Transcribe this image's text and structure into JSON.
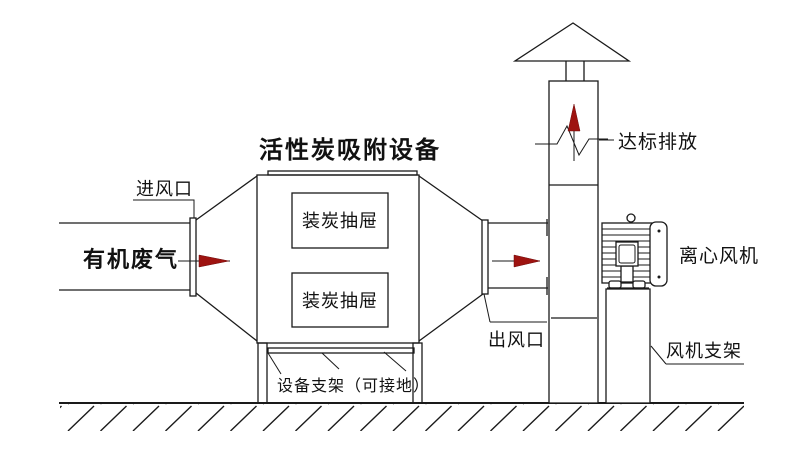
{
  "diagram": {
    "title": "活性炭吸附设备",
    "labels": {
      "inlet_port": "进风口",
      "organic_waste_gas": "有机废气",
      "carbon_drawer": "装炭抽屉",
      "outlet_port": "出风口",
      "compliant_emission": "达标排放",
      "centrifugal_fan": "离心风机",
      "fan_bracket": "风机支架",
      "equipment_bracket": "设备支架（可接地）"
    },
    "colors": {
      "line": "#1a1a1a",
      "arrow_red": "#9e1310",
      "background": "#ffffff"
    }
  }
}
